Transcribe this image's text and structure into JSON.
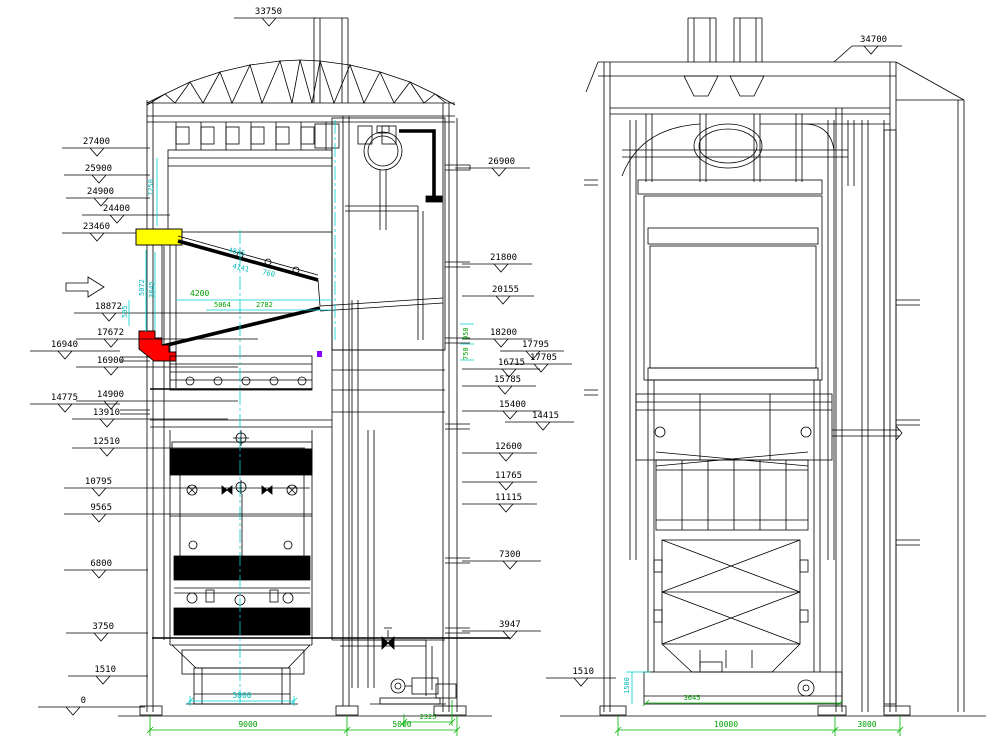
{
  "drawing_type": "boiler elevation CAD drawing, two views",
  "colors": {
    "line": "#000000",
    "dim_green": "#00b400",
    "dim_cyan": "#00d2d2",
    "highlight_yellow": "#ffff00",
    "highlight_red": "#ff0000"
  },
  "lv": {
    "ml": [
      "33750",
      "27400",
      "25900",
      "24900",
      "24400",
      "23460",
      "18872",
      "17672",
      "16940",
      "16900",
      "14775",
      "14900",
      "13910",
      "12510",
      "10795",
      "9565",
      "6800",
      "3750",
      "1510",
      "0"
    ],
    "mr": [
      "26900",
      "21800",
      "20155",
      "18200",
      "17795",
      "17705",
      "16715",
      "15785",
      "15400",
      "14415",
      "12600",
      "11765",
      "11115",
      "7300",
      "3947"
    ],
    "dg": {
      "b1": "9000",
      "b2": "5000",
      "pump": "2325",
      "w1": "4200",
      "w2": "5064",
      "w3": "2782",
      "s1": "950",
      "s2": "750"
    },
    "dc": {
      "bin": "5000",
      "v1": "7250",
      "v2": "5072",
      "v3": "3845",
      "v4": "595",
      "sl1": "4845",
      "sl2": "4141",
      "sl3": "760"
    }
  },
  "rv": {
    "m_top": "34700",
    "m_bot": "1510",
    "dg": {
      "b1": "10000",
      "b2": "3000",
      "w1": "3645"
    },
    "dc": {
      "v1": "1500"
    }
  }
}
